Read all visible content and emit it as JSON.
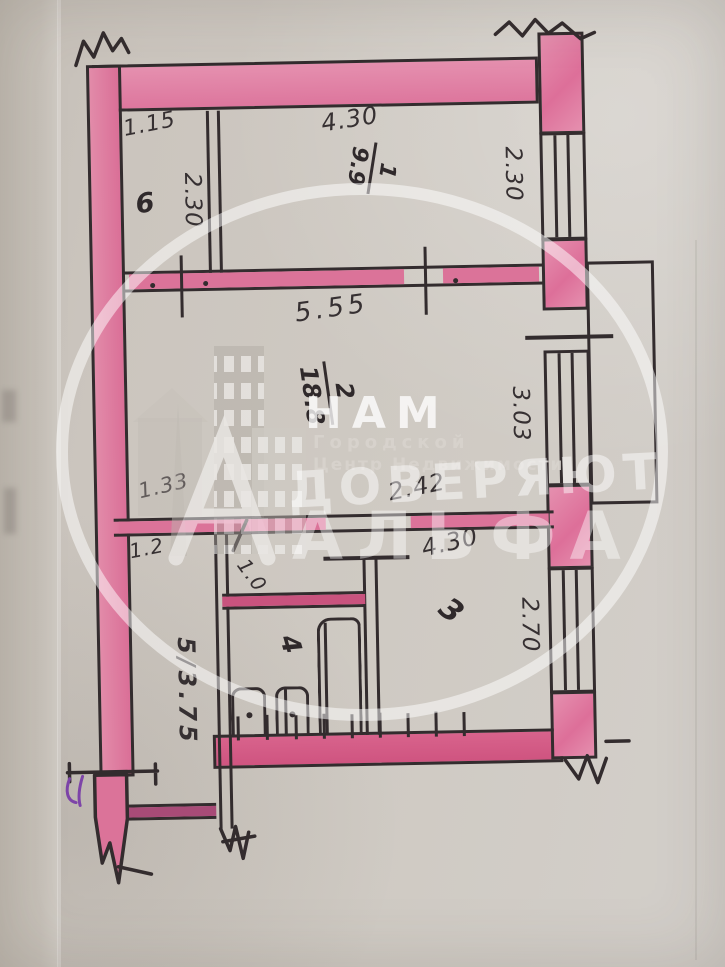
{
  "document": {
    "kind": "hand-drawn apartment floor plan (BTI sketch photo)"
  },
  "rooms": {
    "r1": {
      "number": "1",
      "area": "9.9"
    },
    "r2": {
      "number": "2",
      "area": "18.8"
    },
    "r3": {
      "number": "3"
    },
    "r4": {
      "number": "4"
    },
    "r5": {
      "label": "5/3.75"
    },
    "r6": {
      "number": "6"
    }
  },
  "dimensions": {
    "room6_top": "1.15",
    "room6_side": "2.30",
    "room1_top": "4.30",
    "room1_side": "2.30",
    "total_width": "5.55",
    "room2_side": "3.03",
    "room2_left": "1.33",
    "room2_inner": "2.42",
    "lower_width": "4.30",
    "room3_side": "2.70",
    "corridor_width": "1.2",
    "door_width": "1.0"
  },
  "watermark": {
    "nam": "НАМ",
    "gorodskoy": "Городской",
    "centr": "Центр Недвижимости",
    "doveryayut": "ДОВЕРЯЮТ",
    "alfa": "АЛЬФА"
  },
  "colors": {
    "wall_highlight": "#e28ba9",
    "wall_dark": "#d05a82",
    "ink": "#332c2e",
    "paper": "#cbc5be",
    "purple_mark": "#7d44a8"
  }
}
